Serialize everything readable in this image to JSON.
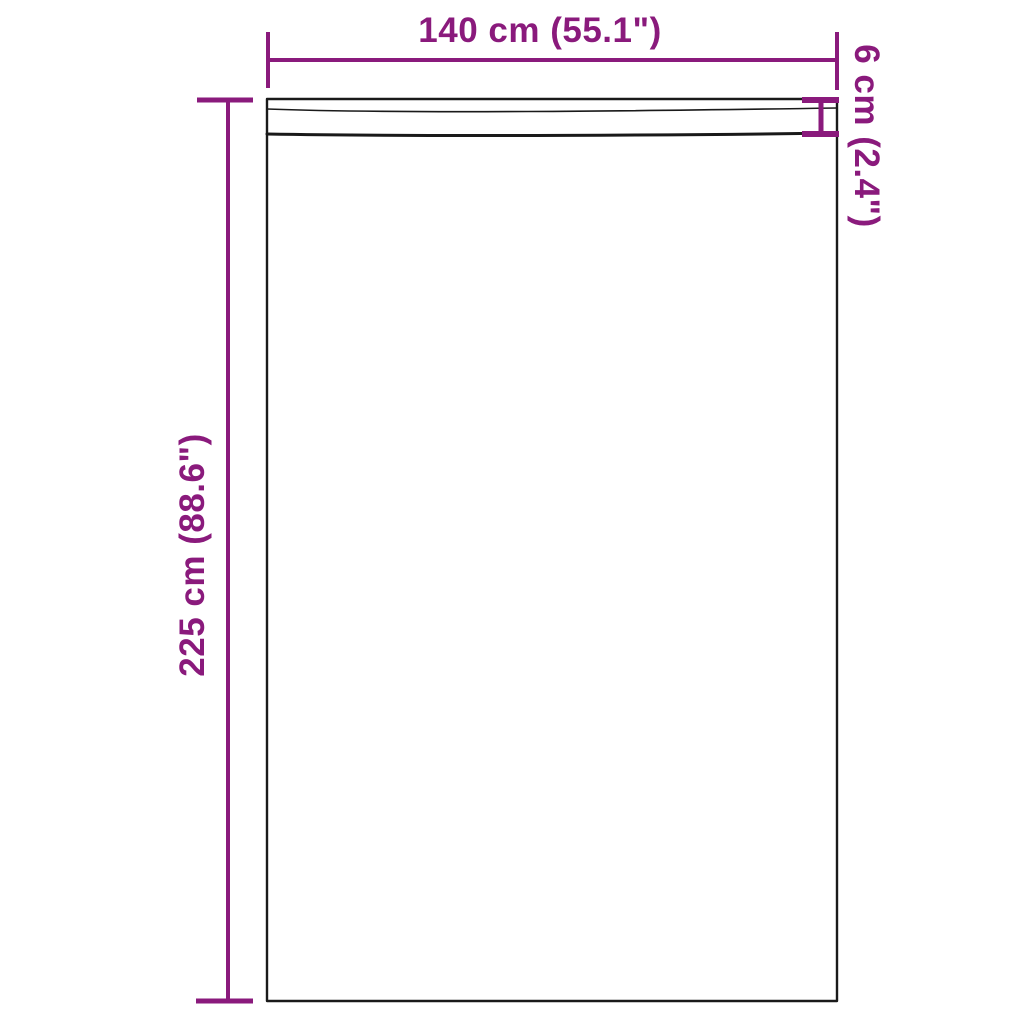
{
  "labels": {
    "width": "140 cm (55.1\")",
    "height": "225 cm (88.6\")",
    "header": "6 cm (2.4\")"
  },
  "colors": {
    "dimension_accent": "#8A1A7C",
    "outline": "#1A1A1A",
    "background": "#FFFFFF"
  }
}
